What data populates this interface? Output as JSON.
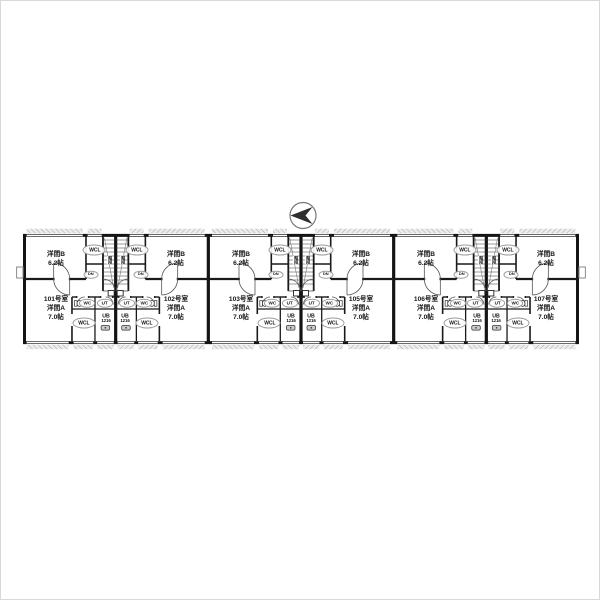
{
  "page": {
    "background": "#ffffff",
    "frame_border": "#d9d9d9"
  },
  "compass": {
    "direction": "left",
    "arrow_color": "#2f2f2f",
    "ring_color": "#777777"
  },
  "plan": {
    "type": "apartment-floor-plan",
    "wall_color": "#141414",
    "hatch_color": "#a8a8a8",
    "shared": {
      "room_b": "洋間B",
      "room_b_size": "6.2帖",
      "room_a": "洋間A",
      "room_a_size": "7.0帖",
      "closet": "WCL",
      "toilet": "WC",
      "utility": "UT",
      "bath": "UB",
      "bath_size": "1216",
      "down": "DN",
      "stairs": "階段"
    },
    "units": [
      {
        "number": "101号室"
      },
      {
        "number": "102号室"
      },
      {
        "number": "103号室"
      },
      {
        "number": "105号室"
      },
      {
        "number": "106号室"
      },
      {
        "number": "107号室"
      }
    ]
  }
}
